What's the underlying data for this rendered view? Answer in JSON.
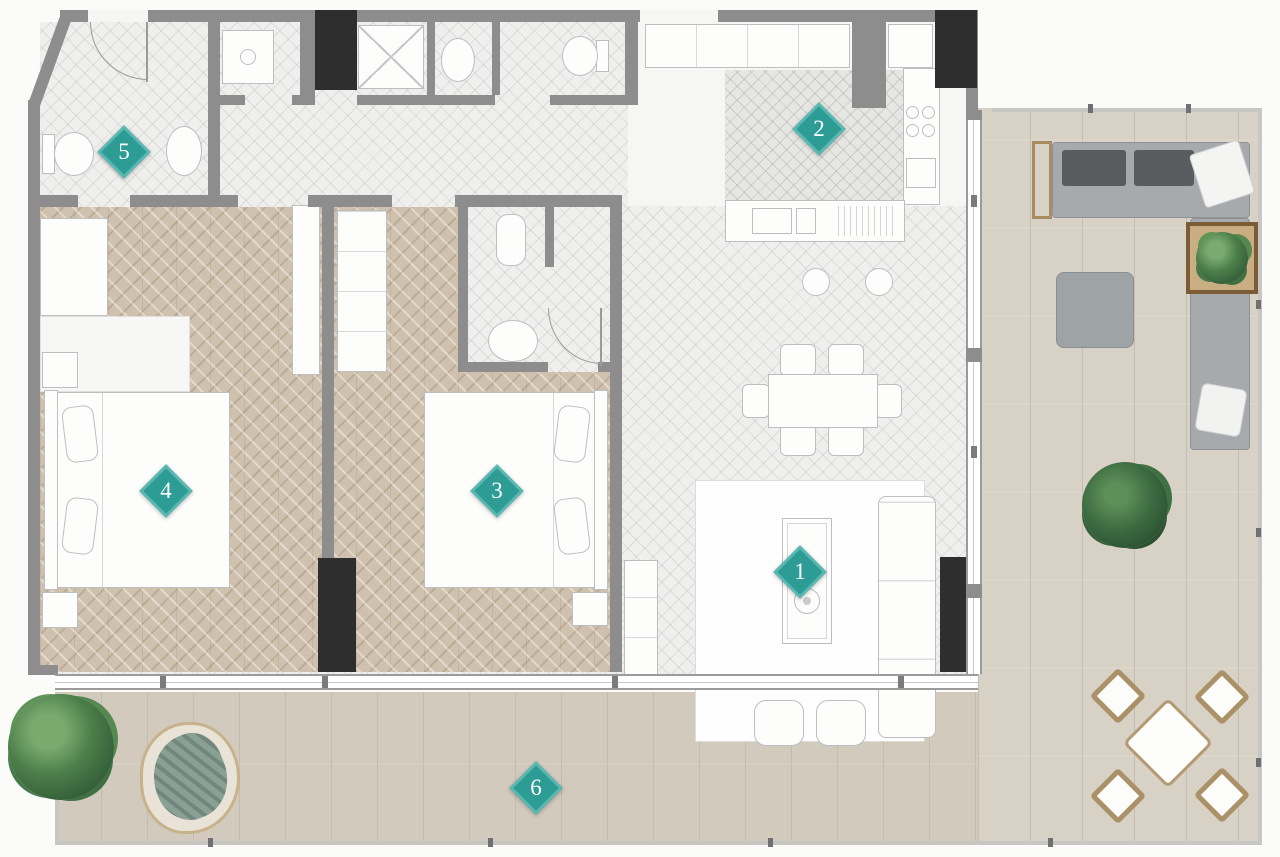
{
  "floor_plan": {
    "title": "apartment-floor-plan-top-view",
    "markers": [
      {
        "number": "1",
        "area": "living-room"
      },
      {
        "number": "2",
        "area": "kitchen"
      },
      {
        "number": "3",
        "area": "bedroom"
      },
      {
        "number": "4",
        "area": "bedroom"
      },
      {
        "number": "5",
        "area": "bathroom"
      },
      {
        "number": "6",
        "area": "terrace"
      }
    ],
    "colors": {
      "marker_teal": "#2d9c94",
      "marker_inner_border": "#82cfc8",
      "wall_gray": "#8d8d8d",
      "shaft_black": "#2e2e2e",
      "tile_floor": "#efefed",
      "bedroom_wood": "#cfc1ae",
      "terrace_deck": "#d8d1c5",
      "plant_green": "#4d7f4a",
      "outdoor_sofa_gray": "#a6aaad",
      "wicker_tan": "#ab9168"
    }
  }
}
